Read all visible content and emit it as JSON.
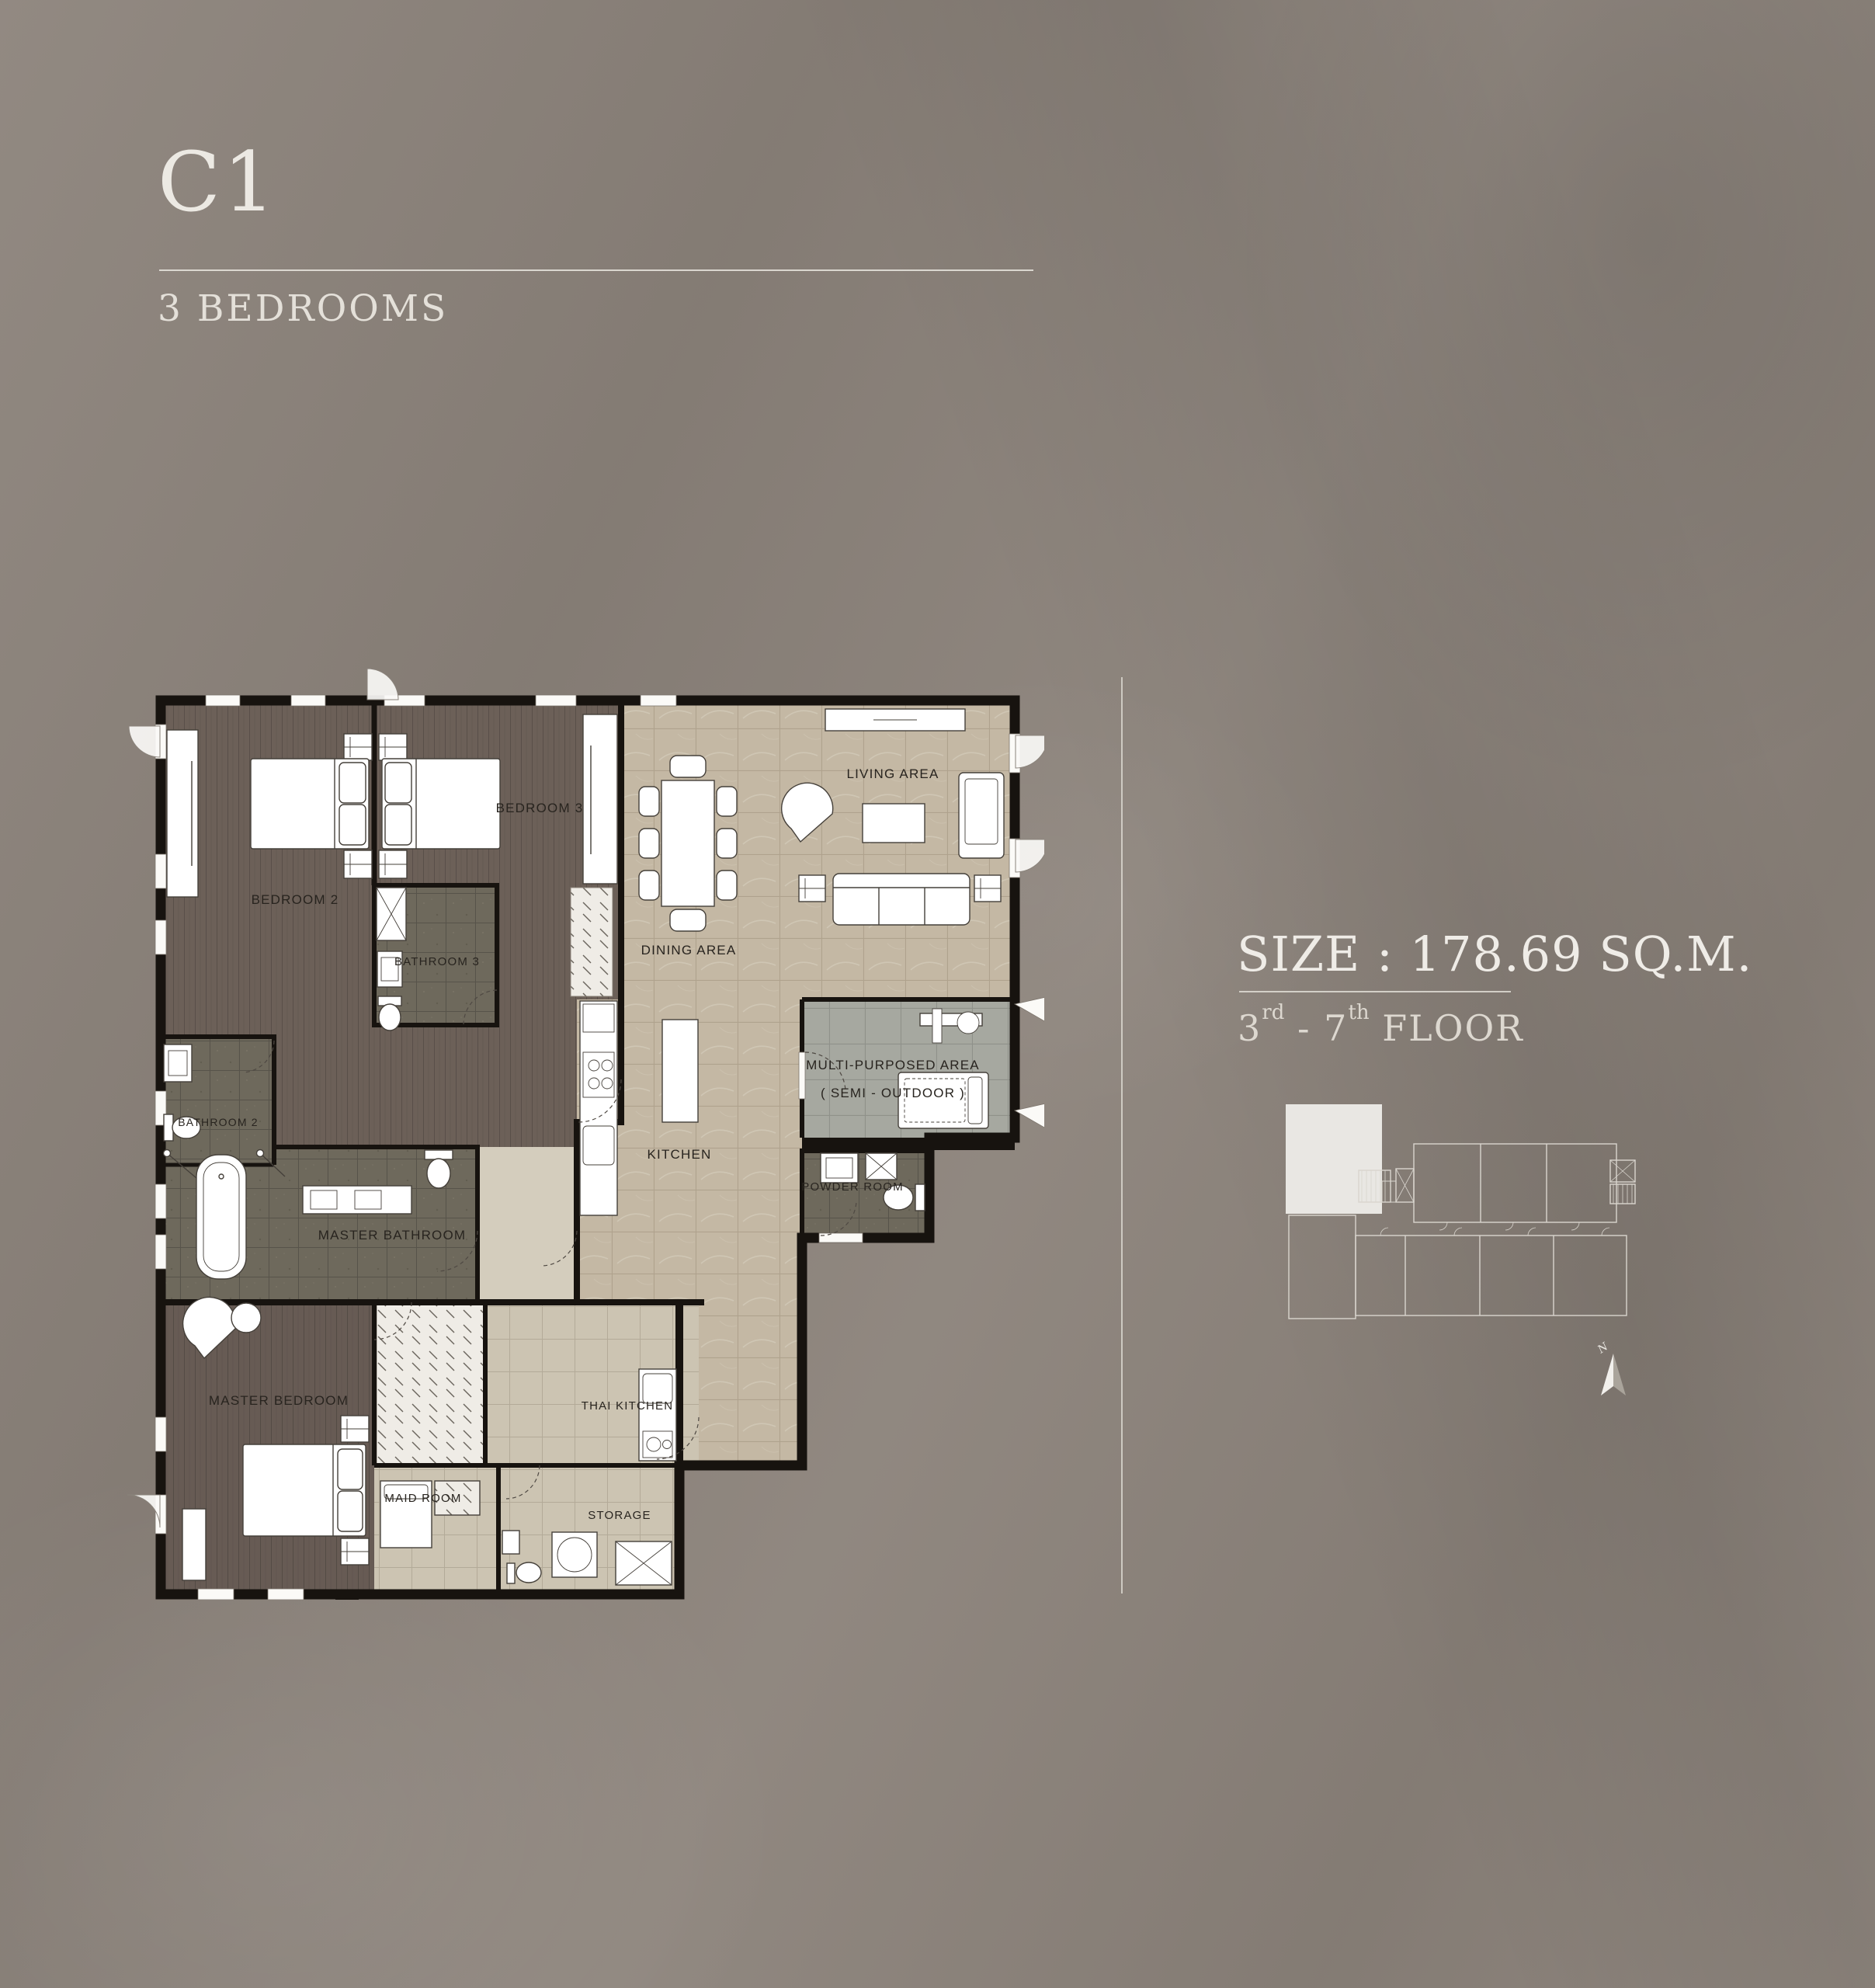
{
  "header": {
    "unit": "C1",
    "type": "3 BEDROOMS"
  },
  "info": {
    "size": "SIZE : 178.69 SQ.M.",
    "floor_from": "3",
    "floor_from_sup": "rd",
    "floor_dash": "- ",
    "floor_to": "7",
    "floor_to_sup": "th",
    "floor_word": " FLOOR"
  },
  "plan": {
    "rooms": [
      {
        "label": "BEDROOM 2"
      },
      {
        "label": "BEDROOM 3"
      },
      {
        "label": "BATHROOM 3"
      },
      {
        "label": "BATHROOM 2"
      },
      {
        "label": "LIVING AREA"
      },
      {
        "label": "DINING AREA"
      },
      {
        "label": "KITCHEN"
      },
      {
        "label": "MULTI-PURPOSED AREA"
      },
      {
        "label": "( SEMI - OUTDOOR )"
      },
      {
        "label": "POWDER ROOM"
      },
      {
        "label": "MASTER BATHROOM"
      },
      {
        "label": "MASTER BEDROOM"
      },
      {
        "label": "THAI KITCHEN"
      },
      {
        "label": "MAID ROOM"
      },
      {
        "label": "STORAGE"
      }
    ]
  },
  "keyplan": {
    "north": "N"
  },
  "colors": {
    "background": "#8c837b",
    "title_text": "#ece9e3",
    "wall": "#17130f",
    "marble_floor": "#c4b8a4",
    "wood_floor": "#6c6058",
    "dark_tile": "#6e695c",
    "gray_tile": "#a6a8a0",
    "beige_tile": "#ccc4b2",
    "keyplan_line": "#d9d5ce",
    "keyplan_highlight": "#e9e7e3"
  }
}
